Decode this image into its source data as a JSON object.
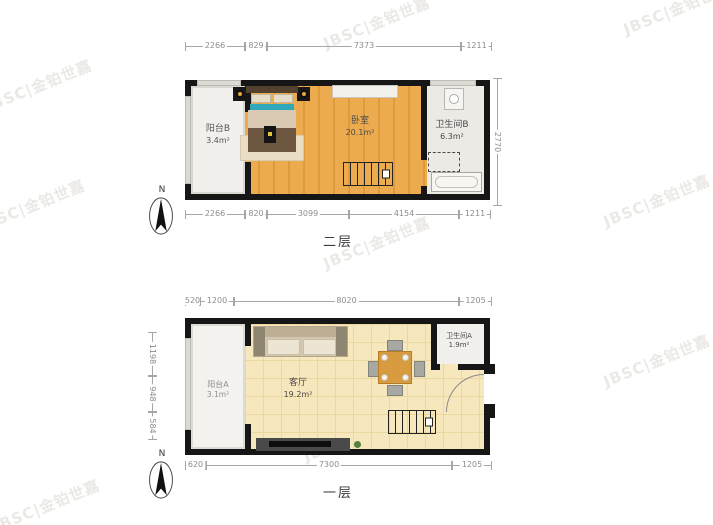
{
  "watermark": {
    "text": "JBSC|金铂世嘉"
  },
  "colors": {
    "wall": "#161616",
    "wood_floor": "#e8a64b",
    "tile_floor": "#f6e6ba",
    "accent_teal": "#2fa8bc",
    "table_wood": "#d89b3f"
  },
  "upper_plan": {
    "floor_label": "二层",
    "north": "N",
    "rooms": {
      "balcony": {
        "name": "阳台B",
        "area": "3.4m²"
      },
      "bedroom": {
        "name": "卧室",
        "area": "20.1m²"
      },
      "bathroom": {
        "name": "卫生间B",
        "area": "6.3m²"
      }
    },
    "dims": {
      "top": [
        "2266",
        "829",
        "7373",
        "1211"
      ],
      "bottom": [
        "2266",
        "820",
        "3099",
        "4154",
        "1211"
      ],
      "right": "2770"
    }
  },
  "lower_plan": {
    "floor_label": "一层",
    "north": "N",
    "rooms": {
      "balcony": {
        "name": "阳台A",
        "area": "3.1m²"
      },
      "living": {
        "name": "客厅",
        "area": "19.2m²"
      },
      "bathroom": {
        "name": "卫生间A",
        "area": "1.9m²"
      }
    },
    "dims": {
      "top": [
        "520",
        "1200",
        "8020",
        "1205"
      ],
      "left": [
        "1198",
        "948",
        "584"
      ],
      "bottom": [
        "620",
        "7300",
        "1205"
      ]
    }
  }
}
